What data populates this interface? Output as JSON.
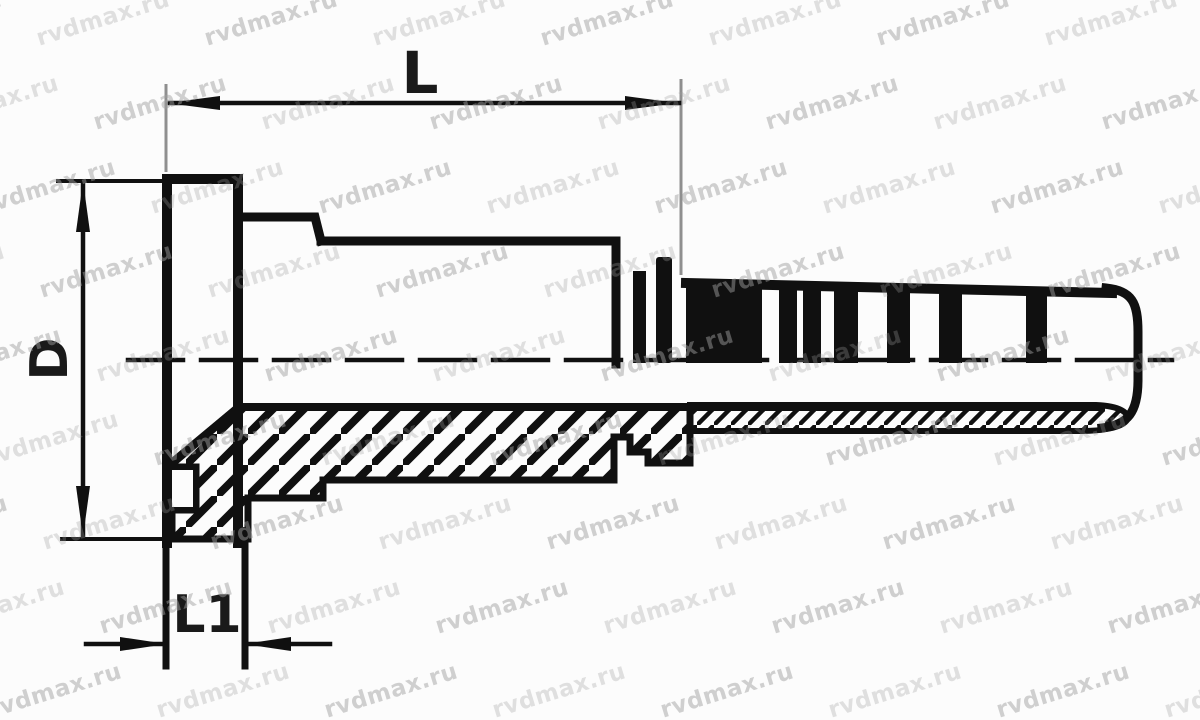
{
  "drawing": {
    "type": "technical-section-drawing",
    "subject": "hydraulic hose flange fitting, half-section side view",
    "labels": {
      "length": "L",
      "diameter": "D",
      "flange_thickness": "L1"
    },
    "colors": {
      "line": "#101010",
      "background": "#fcfcfc",
      "extension_line": "#8f8f8f",
      "label": "#1a1a1a",
      "watermark": "#a0a0a0"
    }
  },
  "watermark": {
    "text": "rvdmax.ru",
    "font_size": 23,
    "rotation_deg": -17,
    "x_step": 168,
    "y_step": 84,
    "row_x_shift": 57,
    "x_start": -50,
    "y_start": 6,
    "rows": 9,
    "cols": 9,
    "opacity_a": 0.3,
    "opacity_b": 0.48
  }
}
